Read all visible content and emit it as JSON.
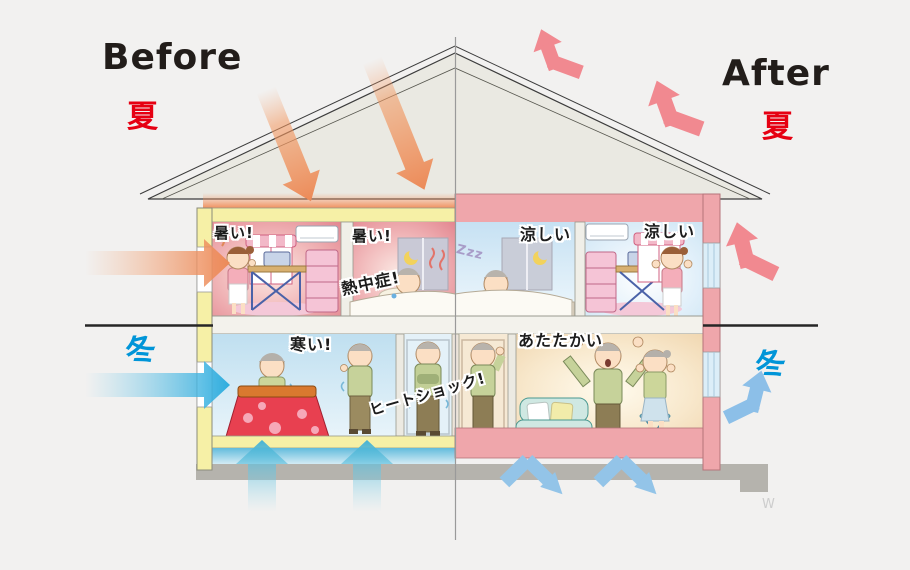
{
  "headers": {
    "before": "Before",
    "after": "After"
  },
  "seasons": {
    "summer_left": "夏",
    "summer_right": "夏",
    "winter_left": "冬",
    "winter_right": "冬"
  },
  "callouts": {
    "room1_hot": "暑い!",
    "bedroom_hot": "暑い!",
    "heatstroke": "熱中症!",
    "bedroom_cool": "涼しい",
    "room2_cool": "涼しい",
    "zzz": "Zzz",
    "cold": "寒い!",
    "heatshock": "ヒートショック!",
    "warm": "あたたかい"
  },
  "watermark": "W",
  "colors": {
    "background": "#f2f1f0",
    "summer_label": "#e60012",
    "winter_label": "#0095d8",
    "before_insulation_yellow": "#f6f0a6",
    "after_insulation_pink": "#efa6ab",
    "heat_arrow_orange": "#ec8a58",
    "reflect_arrow_pink": "#f18990",
    "cold_arrow_teal": "#45b2d4",
    "cold_reflect_blue": "#92c2e8",
    "hot_room": "#e2838d",
    "cool_room": "#cfe6f4",
    "warm_room": "#f3ddba"
  }
}
